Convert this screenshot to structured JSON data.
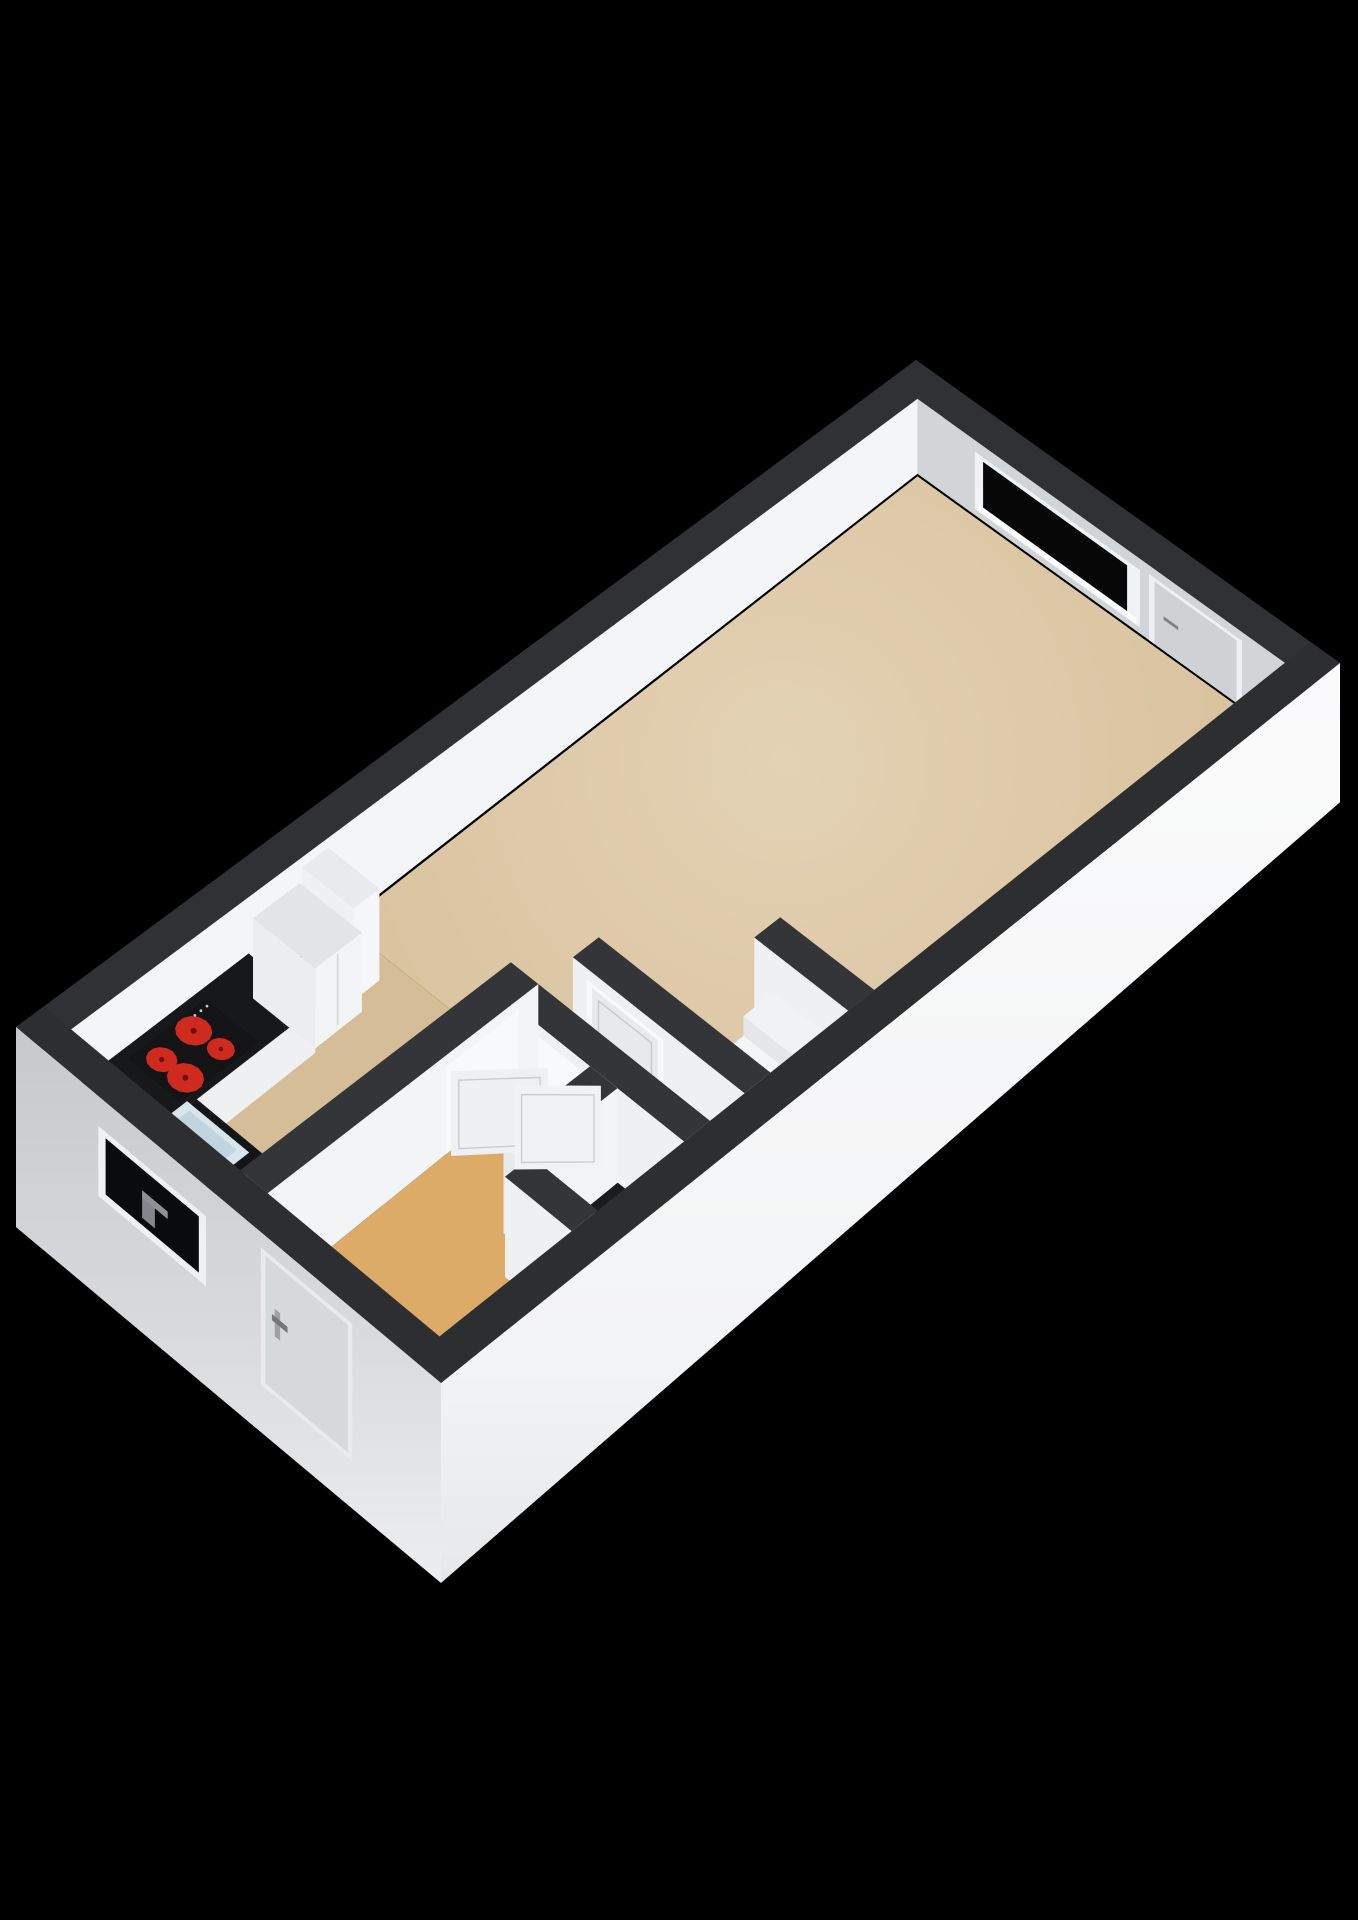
{
  "meta": {
    "title": "3D isometric floor plan render of a studio apartment",
    "background": "#000000",
    "canvas": {
      "width": 1358,
      "height": 1920
    }
  },
  "scene": {
    "rooms": [
      {
        "name": "living-room",
        "floor_color": "#d8c19c"
      },
      {
        "name": "kitchen-zone",
        "floor_color": "#d5bd97"
      },
      {
        "name": "entry-room",
        "floor_color": "#ddab68"
      },
      {
        "name": "wc-niche",
        "floor_color": "#e7e5e0"
      }
    ],
    "fixtures": [
      "kitchen-counter",
      "kitchen-sink",
      "cooktop-4-burners",
      "tall-cabinet",
      "fridge-cabinet",
      "toilet",
      "steps",
      "interior-doors",
      "windows",
      "entrance-door",
      "balcony-door"
    ],
    "accent_colors": {
      "burner_red": "#ce2b1e",
      "wall_top_charcoal": "#303134",
      "glass_black": "#070708"
    }
  },
  "projection": {
    "corners": {
      "W": [
        16,
        1027
      ],
      "N": [
        916,
        360
      ],
      "E": [
        1340,
        663
      ],
      "S": [
        441,
        1383
      ]
    },
    "plan_size": [
      10.4,
      4.65
    ],
    "z_perspective": [
      1.25,
      0.38
    ],
    "z_floor": 85,
    "z_ground": 160
  },
  "gradients": [
    {
      "id": "gSE",
      "kind": "linear",
      "stops": [
        [
          0,
          "#fbfbfc"
        ],
        [
          0.75,
          "#f3f4f5"
        ],
        [
          1,
          "#e7e8ea"
        ]
      ]
    },
    {
      "id": "gSW",
      "kind": "linear",
      "stops": [
        [
          0,
          "#c6c8cb"
        ],
        [
          0.55,
          "#d8dadc"
        ],
        [
          1,
          "#eceeef"
        ]
      ]
    },
    {
      "id": "gFloor",
      "kind": "radial",
      "cx": 785,
      "cy": 762,
      "r": 520,
      "stops": [
        [
          0,
          "rgba(255,249,238,0.30)"
        ],
        [
          1,
          "rgba(255,249,238,0)"
        ]
      ]
    }
  ],
  "geometry": {
    "elements": [
      {
        "name": "nw-wall-top",
        "type": "floor",
        "rect": [
          0,
          0,
          10.4,
          0.3
        ],
        "z": 0,
        "fill": "#303134"
      },
      {
        "name": "nw-wall-face-interior",
        "type": "wallrect",
        "plane": "y",
        "c": 0.3,
        "u": [
          0,
          10.4
        ],
        "z": [
          0,
          85
        ],
        "fill": "#f4f5f7"
      },
      {
        "name": "nw-wall-endcap",
        "type": "wallrect",
        "plane": "x",
        "c": 0,
        "u": [
          0,
          0.3
        ],
        "z": [
          0,
          160
        ],
        "fill": "#a7aaad"
      },
      {
        "name": "ne-wall-top",
        "type": "floor",
        "rect": [
          10.1,
          0,
          10.4,
          4.65
        ],
        "z": 0,
        "fill": "#303134"
      },
      {
        "name": "ne-wall-face-interior",
        "type": "wallrect",
        "plane": "x",
        "c": 10.1,
        "u": [
          0.3,
          4.35
        ],
        "z": [
          0,
          85
        ],
        "fill": "#d2d5d8"
      },
      {
        "name": "ne-window-frame",
        "type": "wallrect",
        "plane": "x",
        "c": 10.1,
        "u": [
          0.93,
          2.74
        ],
        "z": [
          13,
          78
        ],
        "fill": "#f1f2f4"
      },
      {
        "name": "ne-window-glass",
        "type": "wallrect",
        "plane": "x",
        "c": 10.1,
        "u": [
          1.02,
          2.6
        ],
        "z": [
          18,
          70
        ],
        "fill": "#070708"
      },
      {
        "name": "ne-window-sill",
        "type": "wallrect",
        "plane": "x",
        "c": 10.1,
        "u": [
          0.97,
          2.7
        ],
        "z": [
          70,
          77
        ],
        "fill": "#fbfcfc"
      },
      {
        "name": "ne-balcony-door-frame",
        "type": "wallrect",
        "plane": "x",
        "c": 10.1,
        "u": [
          2.84,
          3.86
        ],
        "z": [
          10,
          85
        ],
        "fill": "#eef0f1"
      },
      {
        "name": "ne-balcony-door-panel",
        "type": "wallrect",
        "plane": "x",
        "c": 10.1,
        "u": [
          2.9,
          3.8
        ],
        "z": [
          14,
          85
        ],
        "fill": "#ced2d5"
      },
      {
        "name": "ne-balcony-door-handle",
        "type": "wallrect",
        "plane": "x",
        "c": 10.1,
        "u": [
          3.0,
          3.16
        ],
        "z": [
          46,
          50
        ],
        "fill": "#7f8285"
      },
      {
        "name": "living-room-floor",
        "type": "floor",
        "rect": [
          3.45,
          0.32,
          10.08,
          4.33
        ],
        "z": 85,
        "fill": "#d8c19c"
      },
      {
        "name": "living-room-floor-glow",
        "type": "floor",
        "rect": [
          3.45,
          0.32,
          10.08,
          4.33
        ],
        "z": 85,
        "fill": "url(#gFloor)"
      },
      {
        "name": "kitchen-floor",
        "type": "floor",
        "rect": [
          0.32,
          0.32,
          3.45,
          2.15
        ],
        "z": 85,
        "fill": "#d5bd97"
      },
      {
        "name": "entry-room-floor",
        "type": "floor",
        "pts": [
          [
            0.32,
            2.45
          ],
          [
            3.15,
            2.45
          ],
          [
            3.15,
            3.3
          ],
          [
            2.15,
            3.3
          ],
          [
            2.15,
            3.6
          ],
          [
            1.85,
            3.6
          ],
          [
            1.85,
            4.33
          ],
          [
            0.32,
            4.33
          ]
        ],
        "z": 85,
        "fill": "#ddab68"
      },
      {
        "name": "wc-niche-floor",
        "type": "floor",
        "rect": [
          2.15,
          3.6,
          3.15,
          4.33
        ],
        "z": 85,
        "fill": "#e7e5e0"
      },
      {
        "name": "kitchen-counter",
        "type": "prism",
        "rect": [
          0.32,
          0.32,
          2.35,
          1.05
        ],
        "ztop": 46,
        "zbot": 85,
        "top": "#17181a",
        "fs": "#eef0f1"
      },
      {
        "name": "kitchen-counter-return",
        "type": "prism",
        "rect": [
          0.32,
          1.05,
          0.98,
          1.8
        ],
        "ztop": 46,
        "zbot": 85,
        "top": "#141518",
        "fs": "#cfdfe9"
      },
      {
        "name": "kitchen-sink-top",
        "type": "floor",
        "rect": [
          0.4,
          1.02,
          0.9,
          1.7
        ],
        "z": 45,
        "fill": "#d8e5ed"
      },
      {
        "name": "kitchen-sink-basin",
        "type": "floor",
        "rect": [
          0.46,
          1.1,
          0.84,
          1.62
        ],
        "z": 44.5,
        "fill": "#c1d4e0"
      },
      {
        "name": "kitchen-faucet",
        "type": "dot",
        "p": [
          0.44,
          1.36
        ],
        "z": 26,
        "r": 3,
        "fill": "#b4b7b9"
      },
      {
        "name": "cooktop",
        "type": "floor",
        "rect": [
          0.85,
          0.42,
          1.75,
          1.0
        ],
        "z": 44.5,
        "fill": "#141416"
      },
      {
        "name": "burner-1",
        "type": "disc",
        "p": [
          1.04,
          0.61
        ],
        "z": 44,
        "r": 0.125,
        "fill": "#ce2b1e"
      },
      {
        "name": "burner-2",
        "type": "disc",
        "p": [
          1.05,
          0.86
        ],
        "z": 44,
        "r": 0.148,
        "fill": "#ce2b1e"
      },
      {
        "name": "burner-3",
        "type": "disc",
        "p": [
          1.44,
          0.58
        ],
        "z": 44,
        "r": 0.148,
        "fill": "#ce2b1e"
      },
      {
        "name": "burner-4",
        "type": "disc",
        "p": [
          1.47,
          0.85
        ],
        "z": 44,
        "r": 0.112,
        "fill": "#ce2b1e"
      },
      {
        "name": "burner-1-center",
        "type": "dot",
        "p": [
          1.04,
          0.61
        ],
        "z": 44,
        "r": 2.6,
        "fill": "#701009"
      },
      {
        "name": "burner-2-center",
        "type": "dot",
        "p": [
          1.05,
          0.86
        ],
        "z": 44,
        "r": 3.0,
        "fill": "#701009"
      },
      {
        "name": "burner-3-center",
        "type": "dot",
        "p": [
          1.44,
          0.58
        ],
        "z": 44,
        "r": 3.0,
        "fill": "#701009"
      },
      {
        "name": "burner-4-center",
        "type": "dot",
        "p": [
          1.47,
          0.85
        ],
        "z": 44,
        "r": 2.3,
        "fill": "#701009"
      },
      {
        "name": "cooktop-knob-1",
        "type": "dot",
        "p": [
          1.56,
          0.48
        ],
        "z": 44,
        "r": 1.4,
        "fill": "#c6c9cb"
      },
      {
        "name": "cooktop-knob-2",
        "type": "dot",
        "p": [
          1.63,
          0.48
        ],
        "z": 44,
        "r": 1.4,
        "fill": "#c6c9cb"
      },
      {
        "name": "cooktop-knob-3",
        "type": "dot",
        "p": [
          1.7,
          0.48
        ],
        "z": 44,
        "r": 1.4,
        "fill": "#c6c9cb"
      },
      {
        "name": "kitchen-tall-cabinet",
        "type": "prism",
        "rect": [
          2.95,
          0.34,
          3.25,
          0.9
        ],
        "ztop": 4,
        "zbot": 85,
        "top": "#e8eaec",
        "fw": "#eef0f2",
        "fs": "#f5f6f8"
      },
      {
        "name": "fridge-cabinet",
        "type": "prism",
        "rect": [
          2.38,
          0.34,
          2.92,
          1.02
        ],
        "ztop": 16,
        "zbot": 85,
        "top": "#e2e4e6",
        "fw": "#ebedef",
        "fs": "#f3f4f6"
      },
      {
        "name": "fridge-door-seam",
        "type": "wallrect",
        "plane": "y",
        "c": 1.02,
        "u": [
          2.63,
          2.65
        ],
        "z": [
          18,
          80
        ],
        "fill": "#d3d6d8"
      },
      {
        "name": "alcove-stub-wall",
        "type": "prism",
        "rect": [
          5.05,
          3.3,
          5.35,
          4.33
        ],
        "ztop": 0,
        "zbot": 85,
        "top": "#333539",
        "fw": "#eef0f2"
      },
      {
        "name": "step-high",
        "type": "prism",
        "rect": [
          4.66,
          3.55,
          5.0,
          4.3
        ],
        "ztop": 32,
        "zbot": 85,
        "top": "#f1f2f4",
        "fw": "#e4e6e8",
        "fs": "#ebedef"
      },
      {
        "name": "step-low",
        "type": "prism",
        "rect": [
          4.3,
          3.55,
          4.66,
          4.3
        ],
        "ztop": 50,
        "zbot": 85,
        "top": "#f4f5f7",
        "fw": "#e4e6e8",
        "fs": "#ebedef"
      },
      {
        "name": "interior-wall-c",
        "type": "prism",
        "rect": [
          3.85,
          2.45,
          4.15,
          4.33
        ],
        "ztop": 0,
        "zbot": 85,
        "top": "#333539",
        "fw": "#eef0f2"
      },
      {
        "name": "door3-frame",
        "type": "wallrect",
        "plane": "x",
        "c": 3.85,
        "u": [
          2.6,
          3.44
        ],
        "z": [
          10,
          85
        ],
        "fill": "#f8f9fa"
      },
      {
        "name": "door3-panel",
        "type": "wallrect",
        "plane": "x",
        "c": 3.85,
        "u": [
          2.66,
          3.38
        ],
        "z": [
          14,
          85
        ],
        "fill": "#e7eaec"
      },
      {
        "name": "door3-panel-inset",
        "type": "wallrect",
        "plane": "x",
        "c": 3.85,
        "u": [
          2.73,
          3.31
        ],
        "z": [
          21,
          78
        ],
        "fill": "none",
        "stroke": "#c6cacd"
      },
      {
        "name": "interior-wall-b",
        "type": "prism",
        "rect": [
          3.15,
          2.45,
          3.45,
          4.33
        ],
        "ztop": 0,
        "zbot": 85,
        "top": "#333539",
        "fw": "#eef0f2"
      },
      {
        "name": "door2-frame",
        "type": "wallrect",
        "plane": "x",
        "c": 3.15,
        "u": [
          2.58,
          3.46
        ],
        "z": [
          10,
          85
        ],
        "fill": "#f8f9fa"
      },
      {
        "name": "interior-wall-a",
        "type": "prism",
        "rect": [
          0.32,
          2.15,
          3.45,
          2.45
        ],
        "ztop": 0,
        "zbot": 85,
        "top": "#333539",
        "fs": "#f3f4f6"
      },
      {
        "name": "door1-frame",
        "type": "wallrect",
        "plane": "y",
        "c": 2.45,
        "u": [
          2.38,
          3.22
        ],
        "z": [
          10,
          85
        ],
        "fill": "#f8f9fa"
      },
      {
        "name": "wc-niche-nw-wall",
        "type": "prism",
        "rect": [
          2.15,
          3.3,
          3.15,
          3.6
        ],
        "ztop": 0,
        "zbot": 85,
        "top": "#333539",
        "fw": "#e7e9eb",
        "fs": "#f3f4f6"
      },
      {
        "name": "toilet-body",
        "type": "prism",
        "rect": [
          2.48,
          3.78,
          2.95,
          4.24
        ],
        "ztop": 52,
        "zbot": 85,
        "top": "#f3f4f6",
        "fw": "#e6e8ea",
        "fs": "#edeff1"
      },
      {
        "name": "toilet-seat-opening",
        "type": "floor",
        "rect": [
          2.54,
          3.85,
          2.89,
          4.14
        ],
        "z": 51,
        "fill": "#1a1b1d"
      },
      {
        "name": "toilet-red-detail-1",
        "type": "dot",
        "p": [
          2.63,
          4.0
        ],
        "z": 51,
        "r": 2.4,
        "fill": "#c2271b"
      },
      {
        "name": "toilet-red-detail-2",
        "type": "dot",
        "p": [
          2.72,
          3.95
        ],
        "z": 51,
        "r": 2.0,
        "fill": "#d23325"
      },
      {
        "name": "wc-niche-sw-stub",
        "type": "prism",
        "rect": [
          1.85,
          3.6,
          2.15,
          4.33
        ],
        "ztop": 0,
        "zbot": 85,
        "top": "#333539",
        "fw": "#eef0f2"
      },
      {
        "name": "door1-panel-open",
        "type": "vpanel",
        "a": [
          2.4,
          2.49
        ],
        "b": [
          2.99,
          2.99
        ],
        "z": [
          12,
          85
        ],
        "fill": "#eef0f2",
        "stroke": "#c9cdd0"
      },
      {
        "name": "door2-panel-open",
        "type": "vpanel",
        "a": [
          3.17,
          3.4
        ],
        "b": [
          2.67,
          2.93
        ],
        "z": [
          12,
          85
        ],
        "fill": "#f0f2f4",
        "stroke": "#c9cdd0"
      },
      {
        "name": "se-wall-top",
        "type": "floor",
        "rect": [
          0,
          4.33,
          10.4,
          4.65
        ],
        "z": 0,
        "fill": "#2d2e30"
      },
      {
        "name": "se-wall-face-exterior",
        "type": "wallrect",
        "plane": "y",
        "c": 4.65,
        "u": [
          0,
          10.4
        ],
        "z": [
          0,
          160
        ],
        "fill": "url(#gSE)"
      },
      {
        "name": "sw-wall-top",
        "type": "floor",
        "rect": [
          0,
          0,
          0.32,
          4.65
        ],
        "z": 0,
        "fill": "#2d2e30"
      },
      {
        "name": "sw-wall-face-exterior",
        "type": "wallrect",
        "plane": "x",
        "c": 0,
        "u": [
          0,
          4.65
        ],
        "z": [
          0,
          160
        ],
        "fill": "url(#gSW)"
      },
      {
        "name": "sw-window-frame",
        "type": "wallrect",
        "plane": "x",
        "c": 0,
        "u": [
          0.9,
          2.08
        ],
        "z": [
          24,
          80
        ],
        "fill": "#eff0f2"
      },
      {
        "name": "sw-window-glass",
        "type": "wallrect",
        "plane": "x",
        "c": 0,
        "u": [
          0.98,
          2.0
        ],
        "z": [
          29,
          74
        ],
        "fill": "#0a0b0c"
      },
      {
        "name": "sw-faucet-silhouette",
        "type": "wallrect",
        "plane": "x",
        "c": 0,
        "u": [
          1.38,
          1.52
        ],
        "z": [
          48,
          68
        ],
        "fill": "#83868a"
      },
      {
        "name": "sw-faucet-spout",
        "type": "wallrect",
        "plane": "x",
        "c": 0,
        "u": [
          1.38,
          1.66
        ],
        "z": [
          46,
          52
        ],
        "fill": "#8d9094"
      },
      {
        "name": "entrance-door-frame",
        "type": "wallrect",
        "plane": "x",
        "c": 0,
        "u": [
          2.68,
          3.68
        ],
        "z": [
          12,
          122
        ],
        "fill": "#e8eaec"
      },
      {
        "name": "entrance-door-panel",
        "type": "wallrect",
        "plane": "x",
        "c": 0,
        "u": [
          2.73,
          3.63
        ],
        "z": [
          16,
          118
        ],
        "fill": "#d6d9db"
      },
      {
        "name": "entrance-door-handle-plate",
        "type": "wallrect",
        "plane": "x",
        "c": 0,
        "u": [
          2.83,
          2.89
        ],
        "z": [
          52,
          74
        ],
        "fill": "#9ea1a4"
      },
      {
        "name": "entrance-door-handle",
        "type": "wallrect",
        "plane": "x",
        "c": 0,
        "u": [
          2.8,
          2.97
        ],
        "z": [
          58,
          63
        ],
        "fill": "#75787b"
      }
    ]
  }
}
